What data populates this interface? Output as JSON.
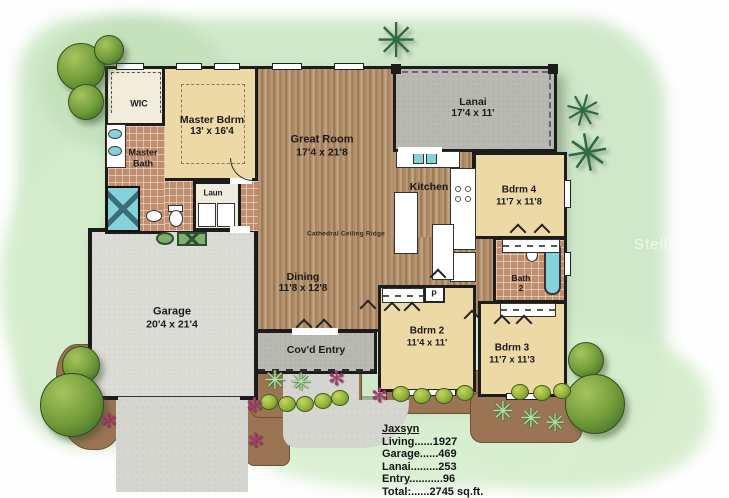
{
  "watermark": "StellarMLS",
  "icons": {
    "palm_tree": "✳",
    "palmetto_plant": "✳",
    "flower": "✻"
  },
  "rooms": {
    "wic": {
      "label": "WIC"
    },
    "master_bdrm": {
      "label": "Master Bdrm",
      "dims": "13' x 16'4"
    },
    "master_bath": {
      "line1": "Master",
      "line2": "Bath"
    },
    "laundry": {
      "label": "Laun"
    },
    "great_room": {
      "label": "Great Room",
      "dims": "17'4 x 21'8"
    },
    "dining": {
      "label": "Dining",
      "dims": "11'8 x 12'8"
    },
    "kitchen": {
      "label": "Kitchen"
    },
    "lanai": {
      "label": "Lanai",
      "dims": "17'4 x 11'"
    },
    "bdrm2": {
      "label": "Bdrm 2",
      "dims": "11'4 x 11'"
    },
    "bdrm3": {
      "label": "Bdrm 3",
      "dims": "11'7 x 11'3"
    },
    "bdrm4": {
      "label": "Bdrm 4",
      "dims": "11'7 x 11'8"
    },
    "bath2": {
      "line1": "Bath",
      "line2": "2"
    },
    "garage": {
      "label": "Garage",
      "dims": "20'4 x 21'4"
    },
    "covd_entry": {
      "label": "Cov'd Entry"
    },
    "pantry": {
      "label": "P"
    }
  },
  "notes": {
    "ceiling": "Cathedral Ceiling Ridge"
  },
  "summary": {
    "plan_name": "Jaxsyn",
    "lines": [
      "Living......1927",
      "Garage......469",
      "Lanai.........253",
      "Entry...........96",
      "Total:......2745 sq.ft."
    ]
  },
  "colors": {
    "wall": "#1c1c1c",
    "wood_floor": "#ad8764",
    "carpet_cream": "#ecd9a6",
    "bath_tile": "#c08e6e",
    "concrete_gray": "#b9b9b2",
    "water_fixture_cyan": "#86d2da",
    "tree_green": "#6f9a38",
    "palm_green": "#2d6b45",
    "flower_magenta": "#a23a6c",
    "background_wash": "#cde7c6"
  }
}
